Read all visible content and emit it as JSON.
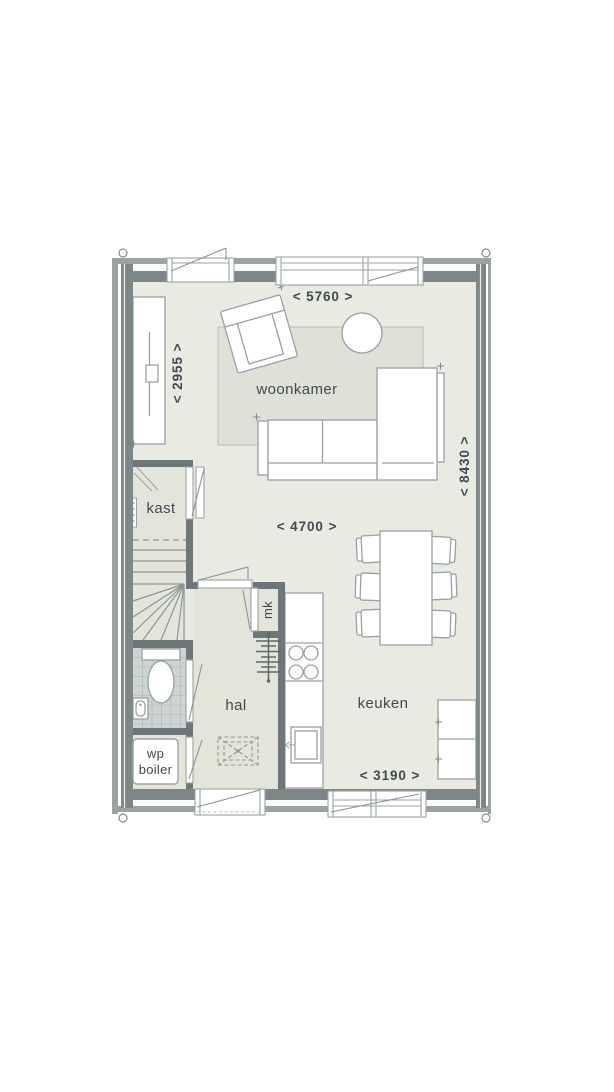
{
  "floor_plan": {
    "rooms": {
      "woonkamer": "woonkamer",
      "kast": "kast",
      "hal": "hal",
      "keuken": "keuken",
      "mk": "mk",
      "wp_boiler_line1": "wp",
      "wp_boiler_line2": "boiler"
    },
    "dimensions": {
      "top_width": "< 5760 >",
      "left_height": "< 2955 >",
      "right_height": "< 8430 >",
      "mid_width": "< 4700 >",
      "bottom_width": "< 3190 >"
    },
    "colors": {
      "background": "#ffffff",
      "floor_main": "#e9eae2",
      "floor_secondary": "#e3e5da",
      "bathroom_tile": "#ced4d3",
      "rug": "#dfe1d8",
      "wall_exterior": "#7d8787",
      "wall_exterior_outer_leaf": "#9aa2a2",
      "wall_interior": "#6d7777",
      "furniture_outline": "#97a1a1",
      "label_text": "#3f4b51"
    }
  }
}
